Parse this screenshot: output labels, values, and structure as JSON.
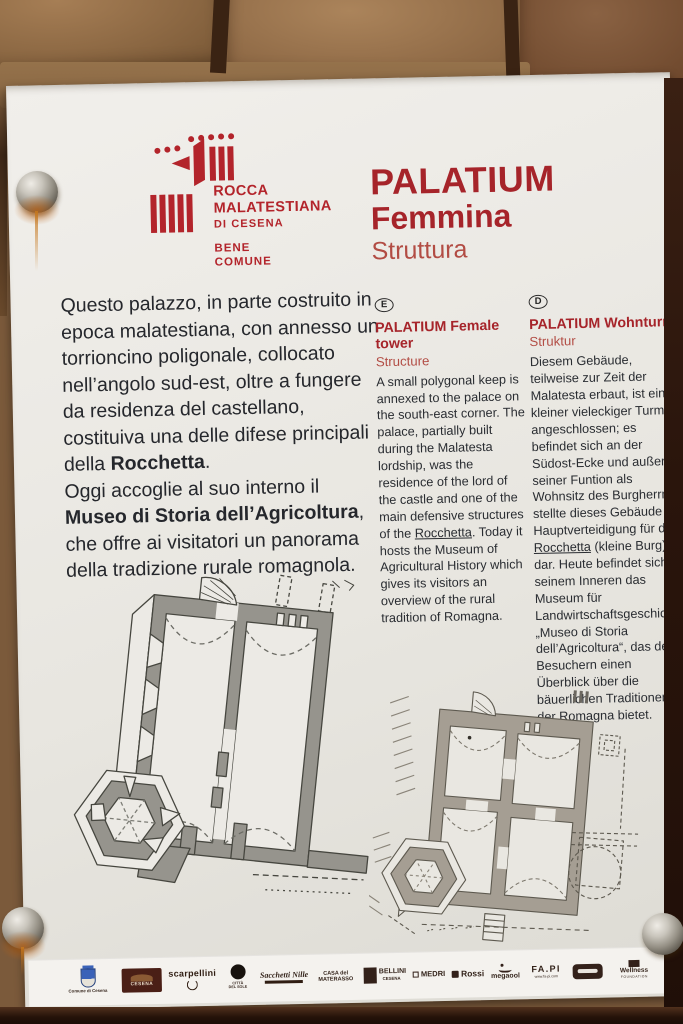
{
  "photo": {
    "wall_color": "#8a6342",
    "sign_color": "#eae8e3",
    "accent_red": "#b0232a"
  },
  "sign": {
    "logo": {
      "name1": "ROCCA",
      "name2": "MALATESTIANA",
      "name3": "DI CESENA",
      "motto1": "BENE",
      "motto2": "COMUNE"
    },
    "title": {
      "line1": "PALATIUM",
      "line2": "Femmina",
      "line3": "Struttura"
    },
    "italian": {
      "p1_a": "Questo palazzo, in parte costruito in epoca malatestiana, con annesso un torrioncino poligonale, collocato nell’angolo sud-est, oltre a fungere da residenza del castellano, costituiva una delle difese principali della ",
      "p1_b": "Rocchetta",
      "p1_c": ".",
      "p2_a": "Oggi accoglie al suo interno il ",
      "p2_b": "Museo di Storia dell’Agricoltura",
      "p2_c": ", che offre ai visitatori un panorama della tradizione rurale romagnola."
    },
    "english": {
      "lang_badge": "E",
      "heading": "PALATIUM Female tower",
      "subheading": "Structure",
      "body_a": "A small polygonal keep is annexed to the palace on the south-east corner. The palace, partially built during the Malatesta lordship, was the residence of the lord of the castle and one of the main defensive structures of the ",
      "body_u": "Rocchetta",
      "body_b": ". Today it hosts the Museum of Agricultural History which gives its visitors an overview of the rural tradition of Romagna."
    },
    "german": {
      "lang_badge": "D",
      "heading": "PALATIUM Wohnturm",
      "subheading": "Struktur",
      "body_a": "Diesem Gebäude, teilweise zur Zeit der Malatesta erbaut, ist ein kleiner vieleckiger Turm angeschlossen; es befindet sich an der Südost-Ecke und außer seiner Funtion als Wohnsitz des Burgherrn stellte dieses Gebäude die Hauptverteidigung für die ",
      "body_u": "Rocchetta",
      "body_b": " (kleine Burg) dar. Heute befindet sich in seinem Inneren das Museum für Landwirtschaftsgeschichte „Museo di Storia dell’Agricoltura“, das den Besuchern einen Überblick über die bäuerlichen Traditionen der Romagna bietet."
    }
  },
  "footer": {
    "logos": [
      {
        "label": "Comune di Cesena"
      },
      {
        "label": "CESENA"
      },
      {
        "label": "scarpellini"
      },
      {
        "label": "CITTÀ DEL SOLE"
      },
      {
        "label": "Sacchetti Nille"
      },
      {
        "label": "CASA del MATERASSO"
      },
      {
        "label": "BELLINI",
        "caption": "CESENA"
      },
      {
        "label": "MEDRI"
      },
      {
        "label": "Rossi"
      },
      {
        "label": "megaool"
      },
      {
        "label": "FA.PI",
        "caption": "www.fa-pi.com"
      },
      {
        "label": ""
      },
      {
        "label": "Wellness",
        "caption": "FOUNDATION"
      }
    ]
  }
}
